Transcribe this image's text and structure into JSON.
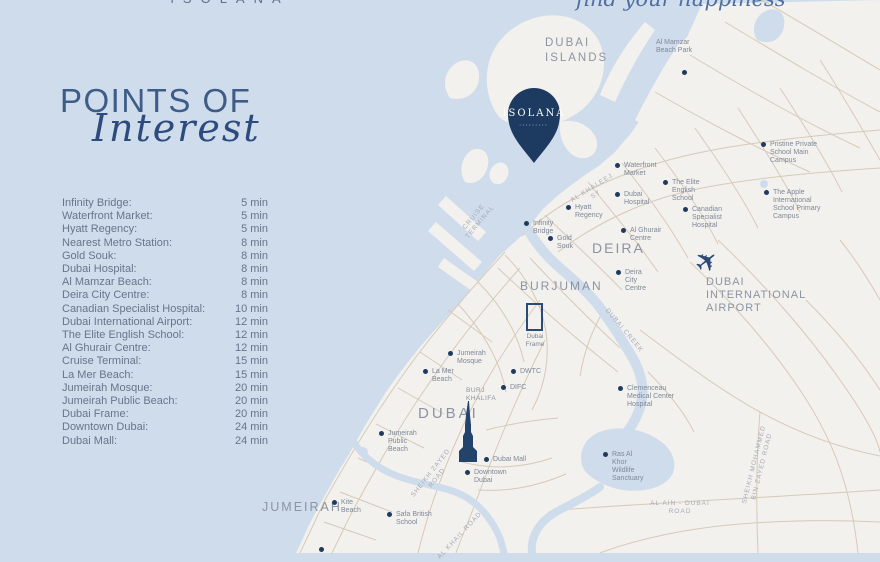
{
  "brand": {
    "logo": "ISOLANA",
    "tagline": "find your happiness",
    "pin": {
      "label": "ISOLANA",
      "sublabel": "•••••••••"
    }
  },
  "title": {
    "line1": "POINTS OF",
    "line2": "Interest"
  },
  "poi_list": [
    {
      "name": "Infinity Bridge:",
      "time": "5 min"
    },
    {
      "name": "Waterfront Market:",
      "time": "5 min"
    },
    {
      "name": "Hyatt Regency:",
      "time": "5 min"
    },
    {
      "name": "Nearest Metro Station:",
      "time": "8 min"
    },
    {
      "name": "Gold Souk:",
      "time": "8 min"
    },
    {
      "name": "Dubai Hospital:",
      "time": "8 min"
    },
    {
      "name": "Al Mamzar Beach:",
      "time": "8 min"
    },
    {
      "name": "Deira City Centre:",
      "time": "8 min"
    },
    {
      "name": "Canadian Specialist Hospital:",
      "time": "10 min"
    },
    {
      "name": "Dubai International Airport:",
      "time": "12 min"
    },
    {
      "name": "The Elite English School:",
      "time": "12 min"
    },
    {
      "name": "Al Ghurair Centre:",
      "time": "12 min"
    },
    {
      "name": "Cruise Terminal:",
      "time": "15 min"
    },
    {
      "name": "La Mer Beach:",
      "time": "15 min"
    },
    {
      "name": "Jumeirah Mosque:",
      "time": "20 min"
    },
    {
      "name": "Jumeirah Public Beach:",
      "time": "20 min"
    },
    {
      "name": "Dubai Frame:",
      "time": "20 min"
    },
    {
      "name": "Downtown Dubai:",
      "time": "24 min"
    },
    {
      "name": "Dubai Mall:",
      "time": "24 min"
    }
  ],
  "map": {
    "districts": {
      "dubai_islands": "DUBAI\nISLANDS",
      "deira": "DEIRA",
      "burjuman": "BURJUMAN",
      "dubai": "DUBAI",
      "jumeirah": "JUMEIRAH"
    },
    "markers": {
      "al_mamzar": {
        "label": "Al Mamzar Beach Park"
      },
      "waterfront": {
        "label": "Waterfront Market"
      },
      "pristine": {
        "label": "Pristine Private School Main Campus"
      },
      "elite": {
        "label": "The Elite English School"
      },
      "dubai_hospital": {
        "label": "Dubai Hospital"
      },
      "hyatt": {
        "label": "Hyatt Regency"
      },
      "apple": {
        "label": "The Apple International School Primary Campus"
      },
      "canadian": {
        "label": "Canadian Specialist Hospital"
      },
      "infinity": {
        "label": "Infinity Bridge"
      },
      "al_ghurair": {
        "label": "Al Ghurair Centre"
      },
      "gold_souk": {
        "label": "Gold Souk"
      },
      "deira_cc": {
        "label": "Deira City Centre"
      },
      "clemenceau": {
        "label": "Clemenceau Medical Center Hospital"
      },
      "jumeirah_mosque": {
        "label": "Jumeirah Mosque"
      },
      "la_mer": {
        "label": "La Mer Beach"
      },
      "dwtc": {
        "label": "DWTC"
      },
      "difc": {
        "label": "DIFC"
      },
      "dubai_mall": {
        "label": "Dubai Mall"
      },
      "downtown": {
        "label": "Downtown Dubai"
      },
      "jumeirah_beach": {
        "label": "Jumeirah Public Beach"
      },
      "ras_al_khor": {
        "label": "Ras Al Khor Wildlife Sanctuary"
      },
      "kite_beach": {
        "label": "Kite Beach"
      },
      "safa": {
        "label": "Safa British School"
      }
    },
    "roads": {
      "al_khaleej": "AL KHALEEJ ST",
      "cruise_terminal": "CRUISE\nTERMINAL",
      "dubai_creek": "DUBAI CREEK",
      "sheikh_zayed": "SHEIKH ZAYED ROAD",
      "al_khail": "AL KHAIL ROAD",
      "al_ain": "AL AIN - DUBAI ROAD",
      "mbz": "SHEIKH MOHAMMED\nBIN ZAYED ROAD"
    },
    "landmarks": {
      "airport": "DUBAI\nINTERNATIONAL\nAIRPORT",
      "burj_khalifa": "BURJ\nKHALIFA",
      "dubai_frame": "Dubai\nFrame"
    }
  },
  "icons": {
    "airplane": "✈"
  },
  "colors": {
    "water": "#cfdcec",
    "land": "#f2f1ee",
    "roads": "#d5c5b2",
    "navy": "#1e3a5e",
    "title_blue": "#3e5c88",
    "label_gray": "#8b94a2"
  }
}
